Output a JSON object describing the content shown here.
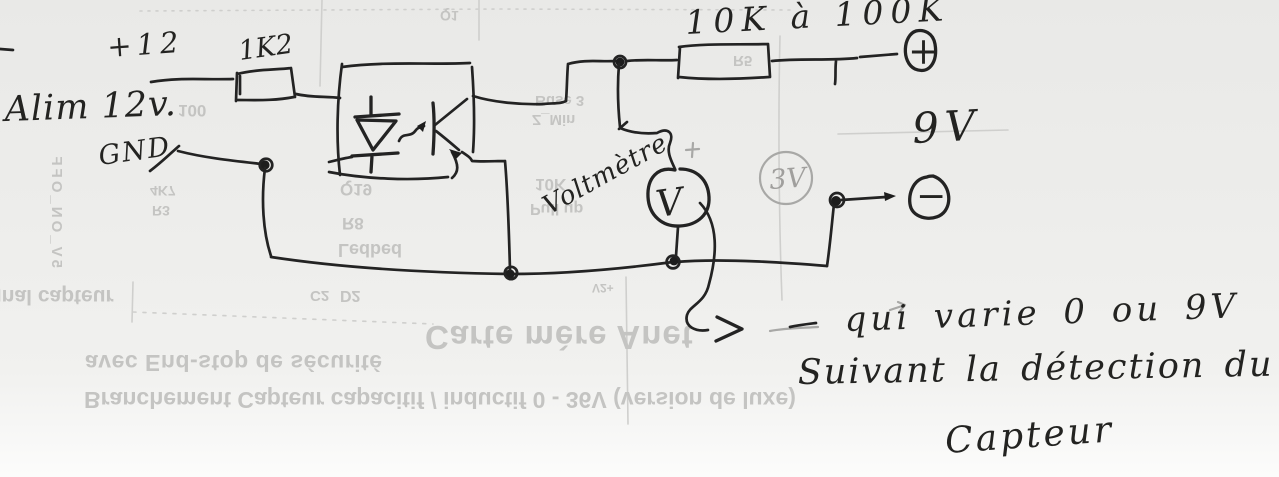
{
  "schematic": {
    "power": {
      "plus_rail": "+12",
      "supply": "Alim 12v.",
      "ground": "GND"
    },
    "components": {
      "r1": "1K2",
      "r2": "10K à 100K",
      "meter_name": "Voltmètre",
      "meter_glyph": "V",
      "pencil_voltage": "3V"
    },
    "terminals": {
      "plus": "+",
      "minus": "−"
    },
    "output": {
      "voltage": "9V"
    },
    "notes": {
      "line1": "qui varie 0 ou 9V",
      "line2": "Suivant la détection du",
      "line3": "Capteur"
    }
  },
  "showthrough": {
    "signal": "Signal capteur",
    "carte_mere": "Carte mère Anet",
    "avec_endstop": "avec End-stop de sécurité",
    "branchement": "Branchement Capteur capacitif / inductif 0 - 36V (version de luxe)",
    "on_off": "5V_ON_OFF",
    "buse": "Buse 3",
    "z_min": "Z_Min",
    "k10": "10K",
    "pull_up": "Pull up",
    "q19": "Q19",
    "r8": "R8",
    "r5": "R5",
    "ledbed": "Ledbed",
    "d2": "D2",
    "c2": "C2",
    "n100": "100",
    "k47": "4K7",
    "r3": "R3",
    "v2": "V2+",
    "q1": "Q1"
  }
}
